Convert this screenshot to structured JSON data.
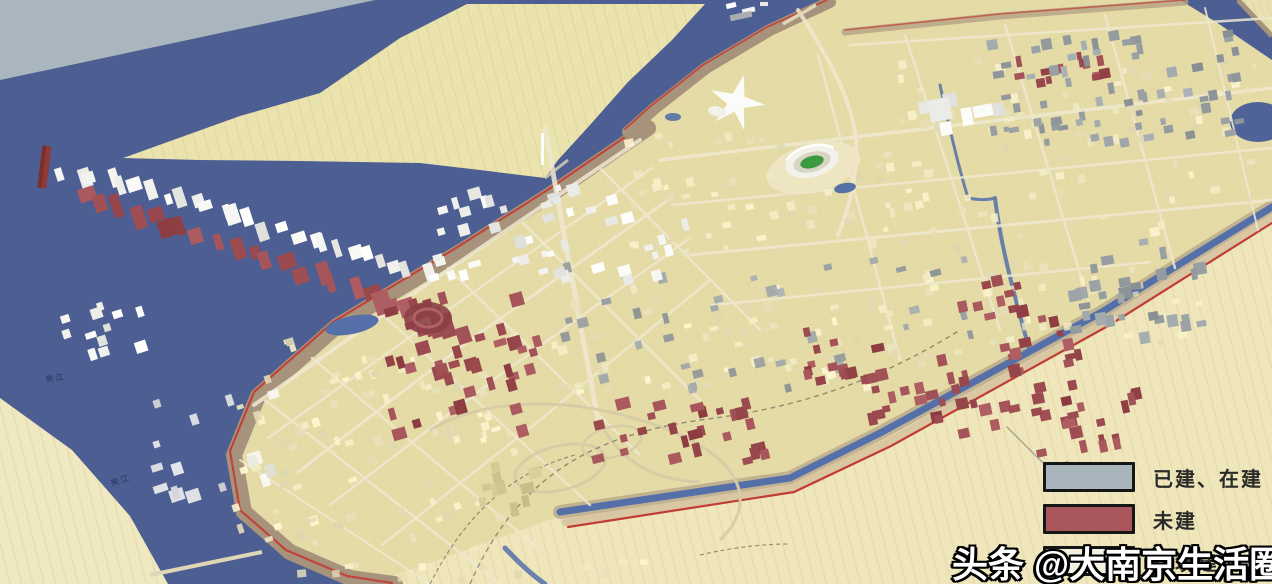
{
  "legend": {
    "items": [
      {
        "id": "built",
        "label": "已建、在建",
        "color": "#a9b5bd"
      },
      {
        "id": "unbuilt",
        "label": "未建",
        "color": "#a9565c"
      },
      {
        "id": "environment",
        "label": "环境建筑",
        "color": "#f5f1e2"
      }
    ]
  },
  "watermark": {
    "text": "头条 @大南京生活圈"
  },
  "map": {
    "river_labels": [
      {
        "text": "夹江"
      },
      {
        "text": "夹江"
      }
    ],
    "colors": {
      "water": "#4d5e93",
      "haze": "#a9b6bd",
      "land": "#e9e0b0",
      "island": "#ebe3ae",
      "farmland": "#f0e8c0",
      "city_ground": "#e3d9a4",
      "shore_brown": "#a7937b",
      "boundary_red": "#c23c34",
      "built_gray": "#9aa1a5",
      "built_white": "#f2f2ef",
      "unbuilt_red": "#9e4d52",
      "cream_block": "#efe8c2",
      "cream_tower": "#d9cf9a",
      "stadium_green": "#3c9a40",
      "canal": "#5570a8",
      "road": "#efe9cf"
    }
  }
}
